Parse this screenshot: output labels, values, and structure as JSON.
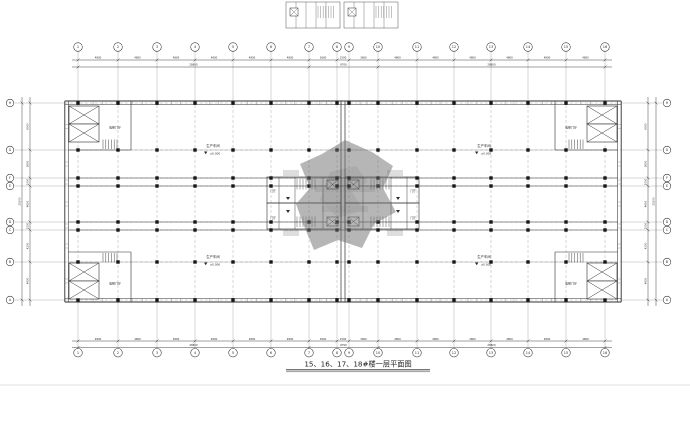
{
  "title": {
    "text": "15、16、17、18#楼一层平面图"
  },
  "colors": {
    "ink": "#2f2f2f",
    "faint": "#9a9a9a",
    "ticks": "#666666",
    "column": "#161616",
    "watermark": "#6f6f6f",
    "sheet_line": "#d9d9d9"
  },
  "grid": {
    "cols": {
      "labels": [
        "1",
        "2",
        "3",
        "4",
        "5",
        "6",
        "7",
        "8",
        "9",
        "10",
        "11",
        "12",
        "13",
        "14",
        "15",
        "16"
      ],
      "x": [
        78,
        118,
        157,
        195,
        233,
        271,
        309,
        337,
        349,
        378,
        417,
        454,
        491,
        528,
        566,
        605
      ]
    },
    "rows": {
      "labels": [
        "A",
        "B",
        "C",
        "D",
        "E",
        "F",
        "G",
        "H"
      ],
      "y": [
        300,
        262,
        230,
        222,
        186,
        178,
        150,
        103
      ]
    }
  },
  "dimensions": {
    "top_bays": [
      "4800",
      "4800",
      "4800",
      "4800",
      "4800",
      "4800",
      "3600",
      "1500",
      "3600",
      "4800",
      "4800",
      "4800",
      "4800",
      "4800",
      "4800"
    ],
    "bottom_bays": [
      "4800",
      "4800",
      "4800",
      "4800",
      "4800",
      "4800",
      "3600",
      "1500",
      "3600",
      "4800",
      "4800",
      "4800",
      "4800",
      "4800",
      "4800"
    ],
    "top_totals": [
      {
        "from": 0,
        "to": 6,
        "label": "28800"
      },
      {
        "from": 6,
        "to": 9,
        "label": "8700"
      },
      {
        "from": 9,
        "to": 15,
        "label": "28800"
      }
    ],
    "bottom_totals": [
      {
        "from": 0,
        "to": 6,
        "label": "28800"
      },
      {
        "from": 6,
        "to": 9,
        "label": "8700"
      },
      {
        "from": 9,
        "to": 15,
        "label": "28800"
      }
    ],
    "side_bays": [
      "4800",
      "4200",
      "1000",
      "4600",
      "1000",
      "3600",
      "6000"
    ],
    "side_total": "25200",
    "joint_width": "11400"
  },
  "rooms": {
    "workshop_label": "生产车间",
    "workshop_elevation": "±0.000",
    "corner_lobby_label": "电梯门厅",
    "core_lobby_label": "门厅"
  }
}
